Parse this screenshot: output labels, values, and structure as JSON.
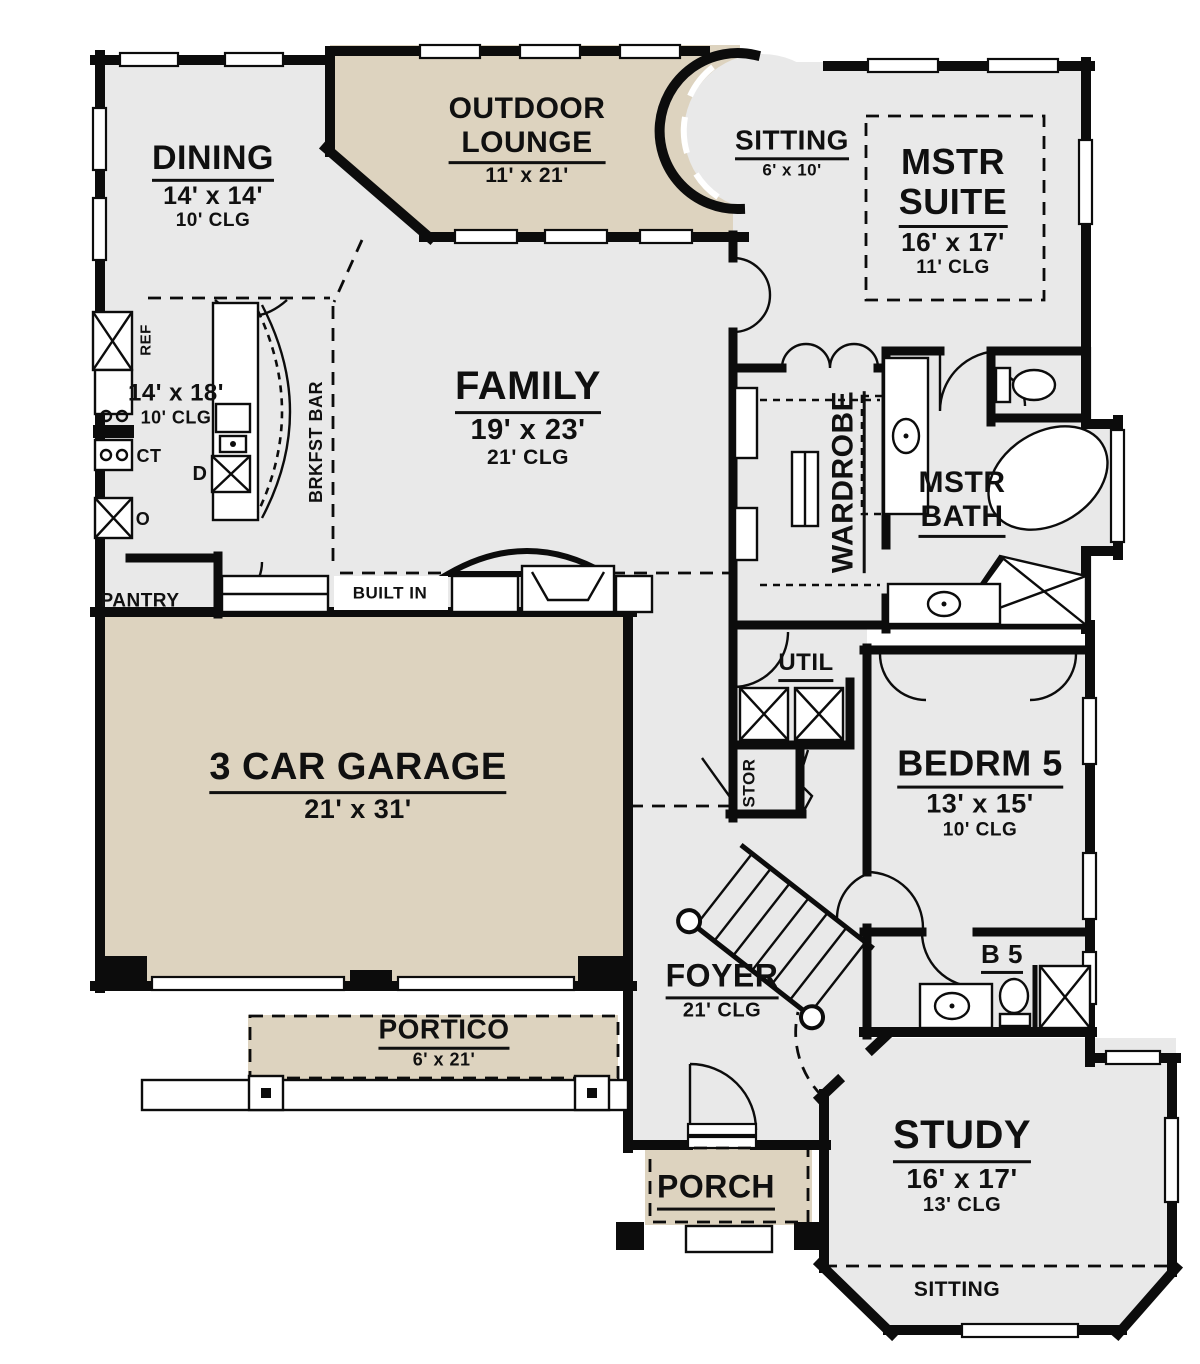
{
  "colors": {
    "bg": "#ffffff",
    "outdoor": "#ddd3bf",
    "interior": "#e9e9e9",
    "wall": "#0c0c0c"
  },
  "rooms": {
    "dining": {
      "name": "DINING",
      "dims": "14' x 14'",
      "clg": "10' CLG"
    },
    "outdoor_lounge": {
      "name1": "OUTDOOR",
      "name2": "LOUNGE",
      "dims": "11' x 21'"
    },
    "sitting_turret": {
      "name": "SITTING",
      "dims": "6' x 10'"
    },
    "mstr_suite": {
      "name1": "MSTR",
      "name2": "SUITE",
      "dims": "16' x 17'",
      "clg": "11' CLG"
    },
    "kitchen": {
      "dims": "14' x 18'",
      "clg": "10' CLG"
    },
    "family": {
      "name": "FAMILY",
      "dims": "19' x 23'",
      "clg": "21' CLG"
    },
    "wardrobe": {
      "name": "WARDROBE"
    },
    "mstr_bath": {
      "name1": "MSTR",
      "name2": "BATH"
    },
    "util": {
      "name": "UTIL"
    },
    "stor": {
      "name": "STOR"
    },
    "bedrm5": {
      "name": "BEDRM 5",
      "dims": "13' x 15'",
      "clg": "10' CLG"
    },
    "garage": {
      "name": "3 CAR GARAGE",
      "dims": "21' x 31'"
    },
    "foyer": {
      "name": "FOYER",
      "clg": "21' CLG"
    },
    "portico": {
      "name": "PORTICO",
      "dims": "6' x 21'"
    },
    "b5": {
      "name": "B 5"
    },
    "porch": {
      "name": "PORCH"
    },
    "study": {
      "name": "STUDY",
      "dims": "16' x 17'",
      "clg": "13' CLG"
    },
    "sitting_bay": {
      "name": "SITTING"
    }
  },
  "annotations": {
    "ref": "REF",
    "ct": "CT",
    "oven": "O",
    "dw": "D",
    "brkfst_bar": "BRKFST BAR",
    "pantry": "PANTRY",
    "built_in": "BUILT IN"
  }
}
